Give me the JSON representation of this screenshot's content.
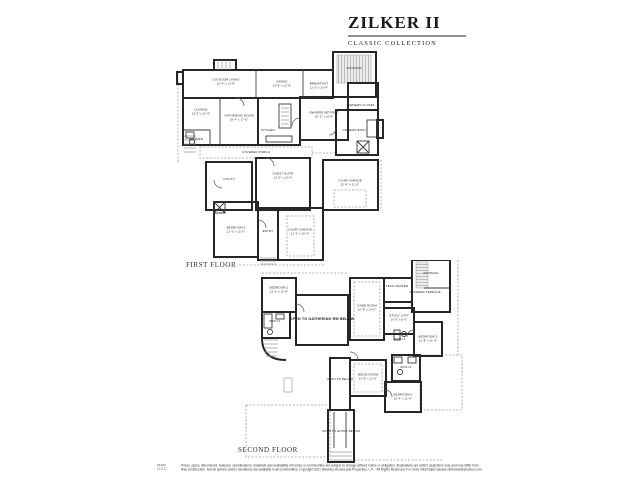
{
  "header": {
    "title": "ZILKER II",
    "subtitle": "CLASSIC COLLECTION"
  },
  "floors": [
    {
      "label": "FIRST FLOOR",
      "rooms": [
        {
          "name": "OUTDOOR LIVING",
          "dims": "21'-4\" x 12'-8\"",
          "x": 32.5,
          "y": 14.7
        },
        {
          "name": "DINING",
          "dims": "13'-6\" x 12'-8\"",
          "x": 55.8,
          "y": 15.6
        },
        {
          "name": "BREAKFAST",
          "dims": "12'-0\" x 10'-4\"",
          "x": 71.2,
          "y": 16.5
        },
        {
          "name": "STORAGE",
          "x": 85.8,
          "y": 8.5
        },
        {
          "name": "OWNERS CLOSET",
          "x": 88.8,
          "y": 25.5
        },
        {
          "name": "OWNERS RETREAT",
          "dims": "16'-2\" x 14'-8\"",
          "x": 73.3,
          "y": 30.0
        },
        {
          "name": "OWNERS BATH",
          "x": 85.8,
          "y": 37.0
        },
        {
          "name": "GATHERING ROOM",
          "dims": "19'-4\" x 17'-0\"",
          "x": 37.9,
          "y": 31.2
        },
        {
          "name": "KITCHEN",
          "x": 50.0,
          "y": 37.0
        },
        {
          "name": "LOUNGE",
          "dims": "12'-0\" x 11'-6\"",
          "x": 22.1,
          "y": 28.5
        },
        {
          "name": "POWDER",
          "x": 20.0,
          "y": 41.3
        },
        {
          "name": "COVERED PORCH",
          "x": 45.0,
          "y": 47.3
        },
        {
          "name": "UTILITY",
          "x": 33.8,
          "y": 59.6
        },
        {
          "name": "GUEST SUITE",
          "dims": "13'-0\" x 12'-4\"",
          "x": 56.3,
          "y": 57.8
        },
        {
          "name": "3-CAR GARAGE",
          "dims": "32'-8\" x 21'-0\"",
          "x": 84.2,
          "y": 61.0
        },
        {
          "name": "BEDROOM 5",
          "dims": "12'-0\" x 11'-0\"",
          "x": 36.7,
          "y": 82.5
        },
        {
          "name": "ENTRY",
          "x": 50.0,
          "y": 83.5
        },
        {
          "name": "2-CAR GARAGE",
          "dims": "21'-0\" x 20'-4\"",
          "x": 63.3,
          "y": 83.5
        }
      ]
    },
    {
      "label": "SECOND FLOOR",
      "rooms": [
        {
          "name": "BEDROOM 2",
          "dims": "13'-0\" x 11'-8\"",
          "x": 20.4,
          "y": 14.6
        },
        {
          "name": "BATH 2",
          "x": 18.8,
          "y": 30.2
        },
        {
          "name": "OPEN TO GATHERING RM BELOW",
          "x": 38.3,
          "y": 29.3,
          "big": true
        },
        {
          "name": "GAME ROOM",
          "dims": "16'-8\" x 14'-0\"",
          "x": 57.1,
          "y": 23.4
        },
        {
          "name": "TECH CENTER",
          "x": 69.6,
          "y": 13.2
        },
        {
          "name": "STORAGE",
          "x": 83.8,
          "y": 6.8
        },
        {
          "name": "COVERED TERRACE",
          "x": 81.3,
          "y": 16.1
        },
        {
          "name": "STUDY LOFT",
          "dims": "10'-0\" x 8'-6\"",
          "x": 70.4,
          "y": 28.3
        },
        {
          "name": "BEDROOM 3",
          "dims": "12'-8\" x 11'-4\"",
          "x": 82.5,
          "y": 38.5
        },
        {
          "name": "BATH 3",
          "x": 70.8,
          "y": 39.0
        },
        {
          "name": "BATH 4",
          "x": 73.3,
          "y": 52.7
        },
        {
          "name": "BEDROOM 4",
          "dims": "12'-4\" x 11'-0\"",
          "x": 72.1,
          "y": 66.8
        },
        {
          "name": "MEDIA ROOM",
          "dims": "13'-8\" x 12'-0\"",
          "x": 57.5,
          "y": 57.1
        },
        {
          "name": "OPEN TO BELOW",
          "x": 45.8,
          "y": 58.5
        },
        {
          "name": "OPEN TO ENTRY BELOW",
          "x": 46.3,
          "y": 83.9
        }
      ]
    }
  ],
  "footer": {
    "code_line1": "6940D",
    "code_line2": "12.6.21",
    "disclaimer_line1": "Prices, plans, dimensions, features, specifications, materials and availability of homes or communities are subject to change without notice or obligation. Illustrations are artist's depictions only and may differ from",
    "disclaimer_line2": "final construction. Not all options and/or elevations are available in all communities. Copyright 2021 Weekley Homes and Properties, L.P. - All Rights Reserved. For more information please visit weekleyhomes.com"
  },
  "colors": {
    "wall": "#262626",
    "overhang": "#9b9b9b",
    "rule": "#8f8f8f",
    "background": "#ffffff"
  }
}
